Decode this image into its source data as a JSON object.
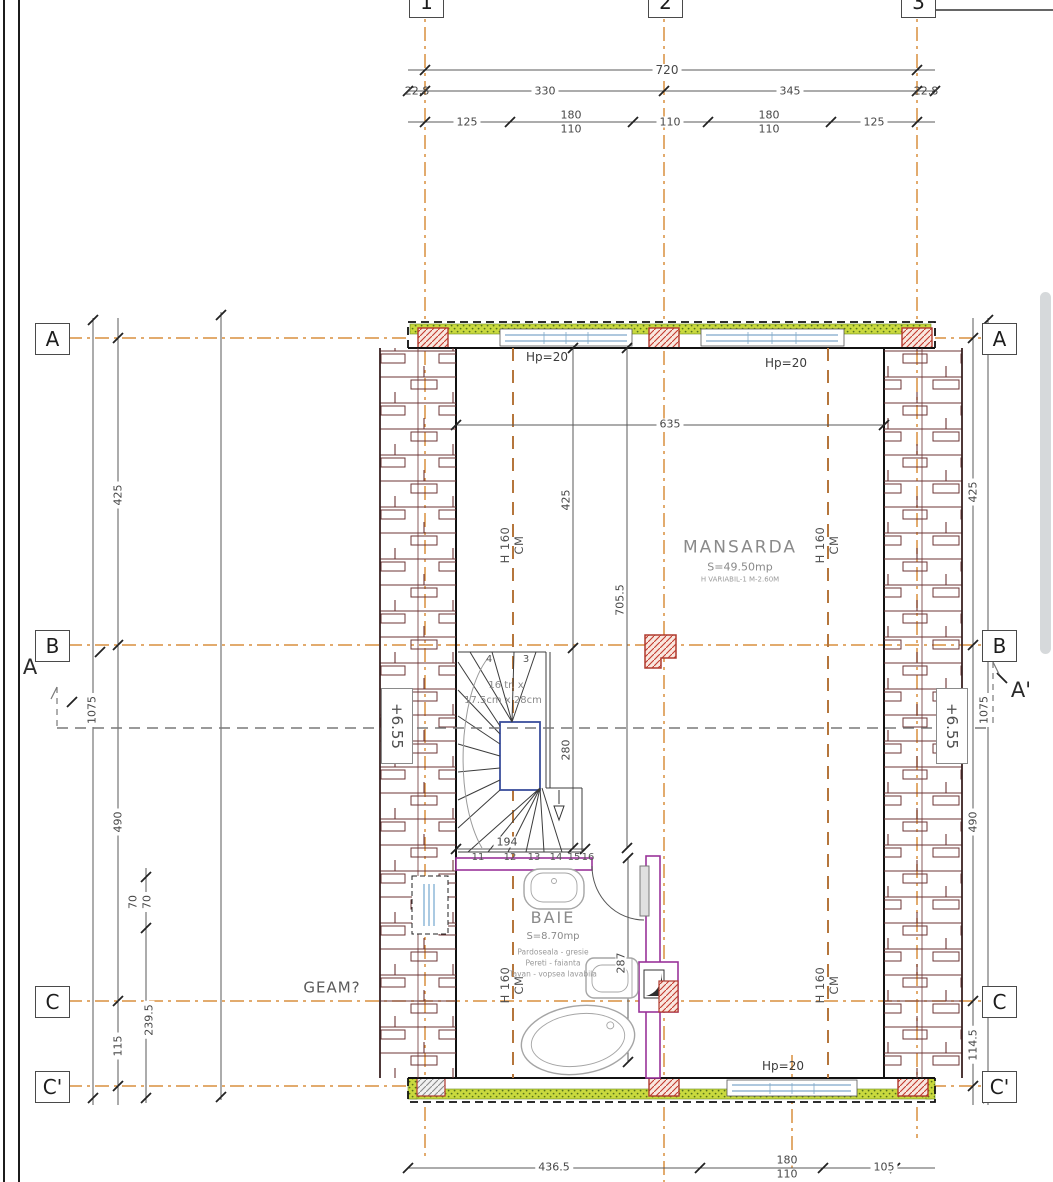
{
  "drawing": {
    "type": "floor plan",
    "level_name": "MANSARDA"
  },
  "colors": {
    "grid_axis": "#d98f3f",
    "wall": "#111111",
    "roof_tile": "#6d3434",
    "insulation": "#c9d93e",
    "pier_hatch": "#c0392b",
    "partition": "#993399",
    "window": "#7fa8c9",
    "dim_text": "#474747"
  },
  "grid": {
    "cols": [
      "1",
      "2",
      "3"
    ],
    "rows": [
      "A",
      "B",
      "C",
      "C'"
    ]
  },
  "sections": {
    "left": "A",
    "right": "A'"
  },
  "levels": {
    "left": "+6.55",
    "right": "+6.55"
  },
  "rooms": {
    "mansarda": {
      "name": "MANSARDA",
      "area": "S=49.50mp",
      "height_note": "H VARIABIL-1 M-2.60M"
    },
    "baie": {
      "name": "BAIE",
      "area": "S=8.70mp",
      "floor": "Pardoseala - gresie",
      "walls": "Pereti - faianta",
      "ceiling": "Tavan - vopsea lavabila"
    }
  },
  "windows": {
    "hp_top_left": "Hp=20",
    "hp_top_right": "Hp=20",
    "hp_bottom": "Hp=20"
  },
  "roof_limit": {
    "h": "H 160",
    "cm": "CM"
  },
  "annotations": {
    "geam": "GEAM?",
    "stair_count": "16 tr. x",
    "stair_size": "17.5cm x 28cm"
  },
  "dims": {
    "top1": "720",
    "top2": [
      "22.8",
      "330",
      "345",
      "22.8"
    ],
    "top3": [
      "125",
      "180",
      "110",
      "110",
      "180",
      "110",
      "125"
    ],
    "bottom": [
      "436.5",
      "180",
      "110",
      "105"
    ],
    "left": [
      "1075",
      "425",
      "490",
      "115",
      "70",
      "70",
      "239.5"
    ],
    "right": [
      "1075",
      "425",
      "490",
      "114.5"
    ],
    "inner": [
      "635",
      "425",
      "280",
      "705.5",
      "287",
      "194"
    ]
  },
  "treads": [
    "4",
    "3",
    "11",
    "12",
    "13",
    "14",
    "15",
    "16"
  ]
}
